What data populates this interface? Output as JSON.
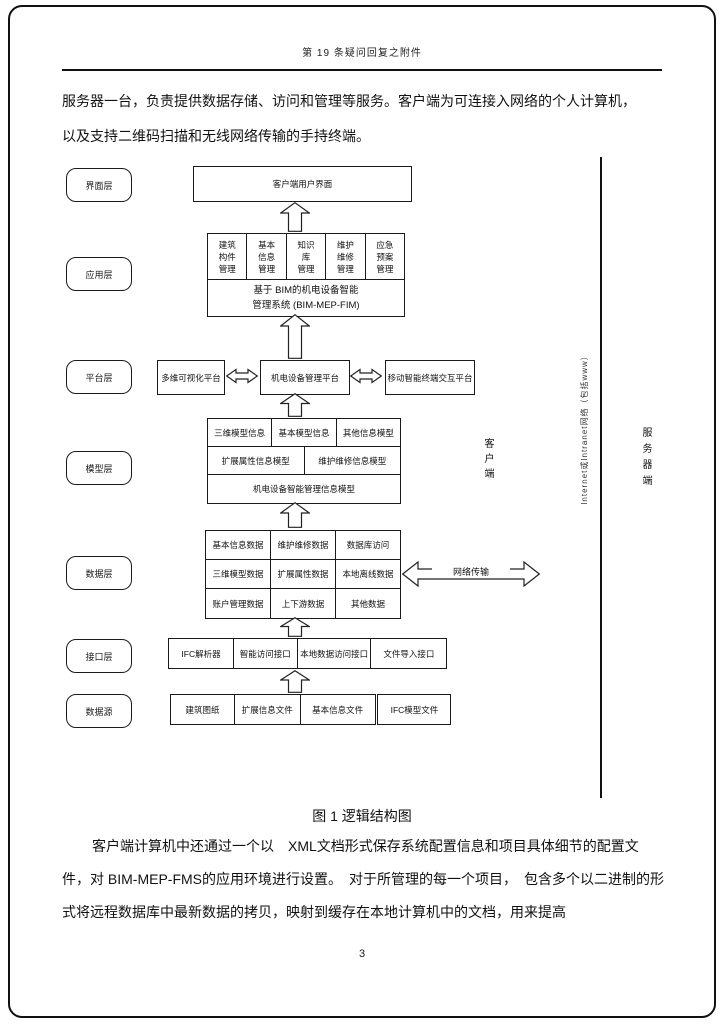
{
  "page": {
    "header": "第 19 条疑问回复之附件",
    "page_number": "3"
  },
  "intro": {
    "line1": "服务器一台，负责提供数据存储、访问和管理等服务。客户端为可连接入网络的个人计算机，",
    "line2": "以及支持二维码扫描和无线网络传输的手持终端。"
  },
  "diagram": {
    "layer_labels": [
      "界面层",
      "应用层",
      "平台层",
      "模型层",
      "数据层",
      "接口层",
      "数据源"
    ],
    "ui_box": "客户端用户界面",
    "app_modules": [
      "建筑\n构件\n管理",
      "基本\n信息\n管理",
      "知识\n库\n管理",
      "维护\n维修\n管理",
      "应急\n预案\n管理"
    ],
    "app_system": "基于 BIM的机电设备智能\n管理系统 (BIM-MEP-FIM)",
    "platform_boxes": [
      "多维可视化平台",
      "机电设备管理平台",
      "移动智能终端交互平台"
    ],
    "model_row1": [
      "三维模型信息",
      "基本模型信息",
      "其他信息模型"
    ],
    "model_row2": [
      "扩展属性信息模型",
      "维护维修信息模型"
    ],
    "model_row3": "机电设备智能管理信息模型",
    "data_grid": [
      [
        "基本信息数据",
        "维护维修数据",
        "数据库访问"
      ],
      [
        "三维模型数据",
        "扩展属性数据",
        "本地离线数据"
      ],
      [
        "账户管理数据",
        "上下游数据",
        "其他数据"
      ]
    ],
    "interface_row": [
      "IFC解析器",
      "智能访问接口",
      "本地数据访问接口",
      "文件导入接口"
    ],
    "source_row": [
      "建筑图纸",
      "扩展信息文件",
      "基本信息文件",
      "IFC模型文件"
    ],
    "side_labels": {
      "client": "客户端",
      "server": "服务器端",
      "network_note": "Internet或Intranet网络（包括www）",
      "network_transfer": "网络传输"
    }
  },
  "caption": "图 1 逻辑结构图",
  "body": {
    "line1": "客户端计算机中还通过一个以　XML文档形式保存系统配置信息和项目具体细节的配置文",
    "line2": "件，对 BIM-MEP-FMS的应用环境进行设置。　对于所管理的每一个项目，　包含多个以二进制的形",
    "line3": "式将远程数据库中最新数据的拷贝，映射到缓存在本地计算机中的文档，用来提高"
  }
}
